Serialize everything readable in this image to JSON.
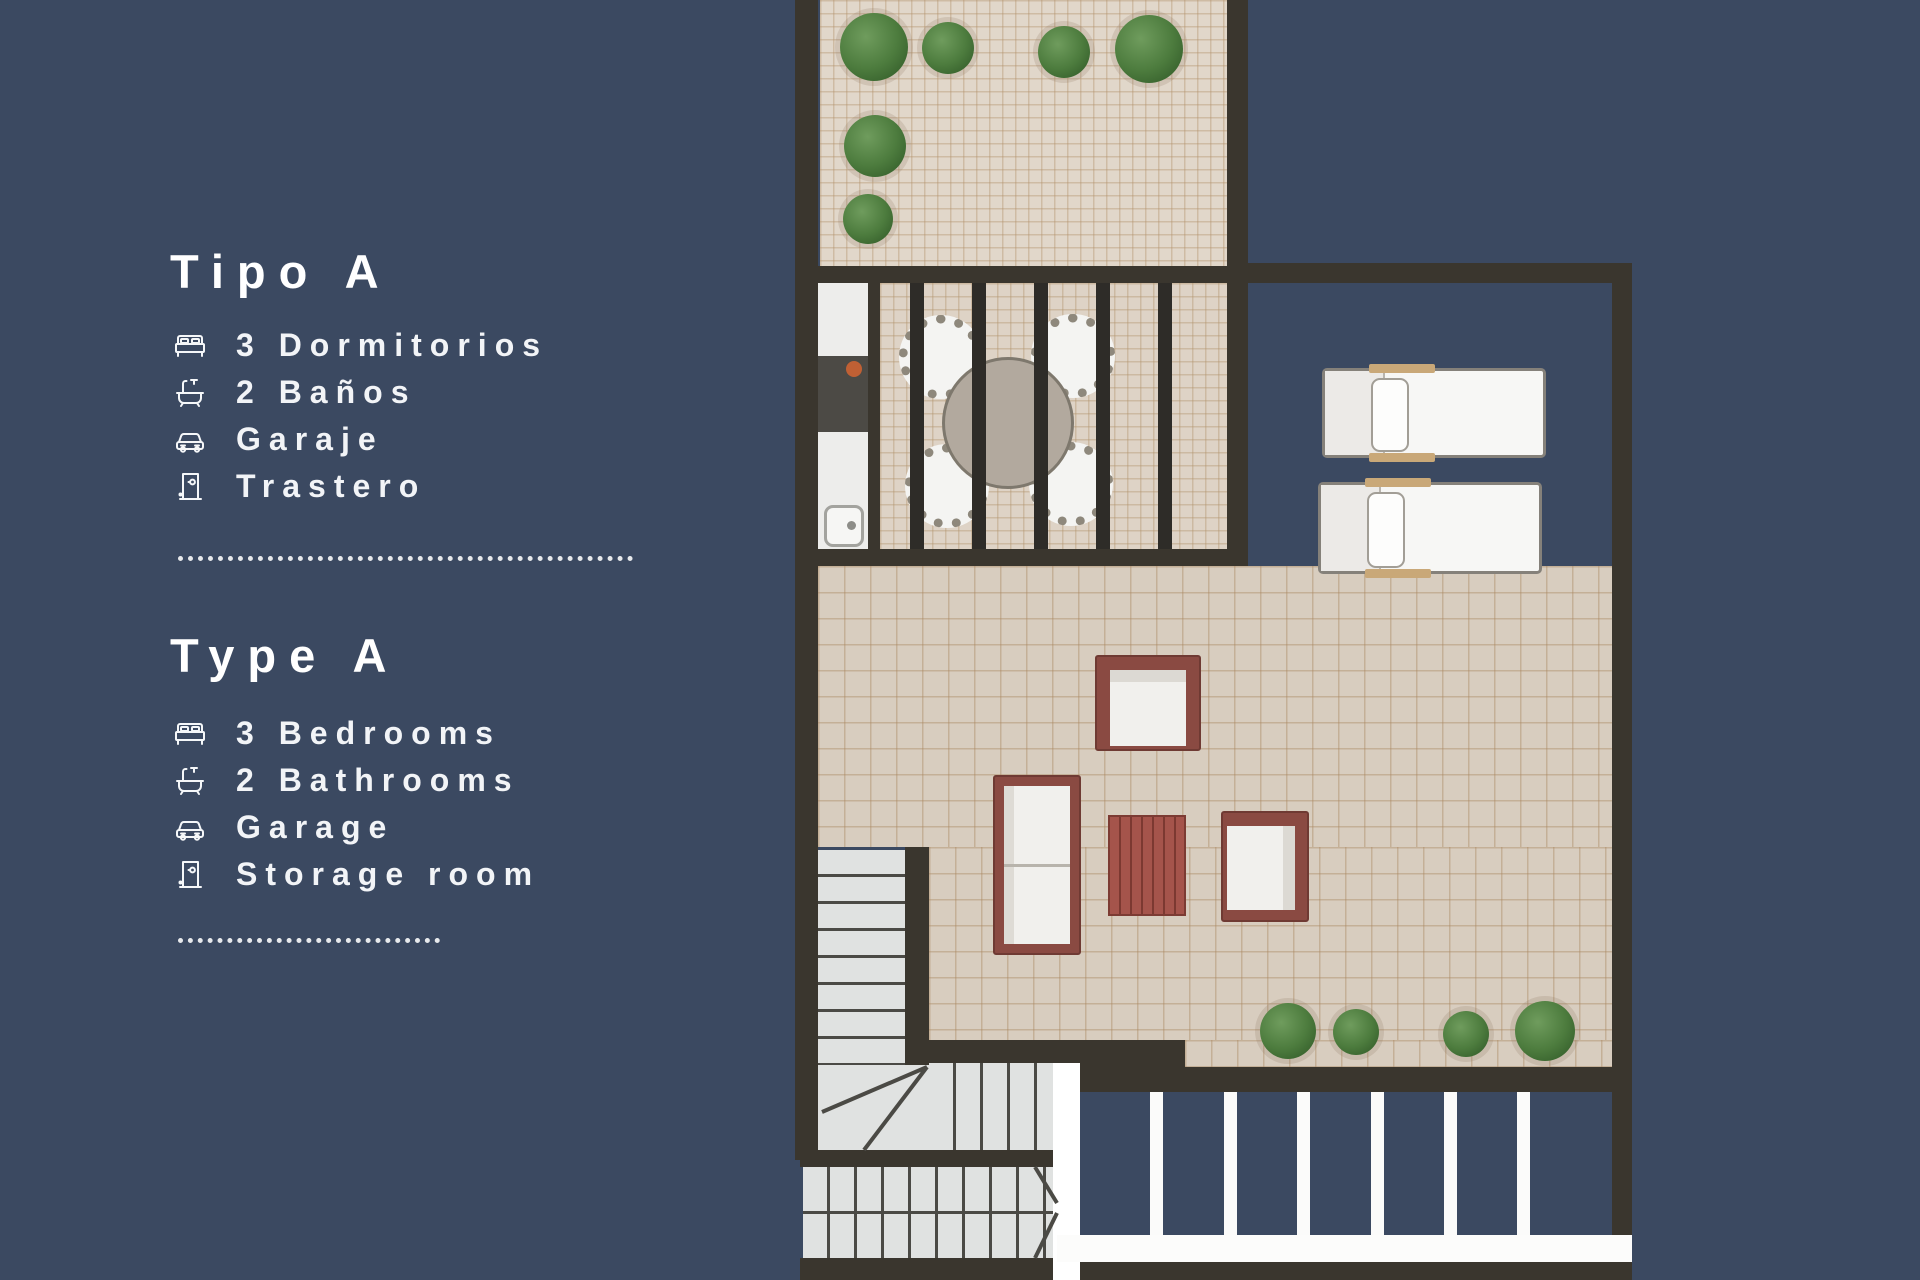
{
  "colors": {
    "background": "#3b4961",
    "wall": "#3a362e",
    "tile": "#d8cdbf",
    "furniture_wood": "#8a4a42",
    "plant_green": "#4d7c3e",
    "text": "#ffffff"
  },
  "legend_es": {
    "title": "Tipo A",
    "items": [
      {
        "icon": "bed-icon",
        "text": "3 Dormitorios"
      },
      {
        "icon": "bath-icon",
        "text": "2 Baños"
      },
      {
        "icon": "car-icon",
        "text": "Garaje"
      },
      {
        "icon": "door-icon",
        "text": "Trastero"
      }
    ]
  },
  "legend_en": {
    "title": "Type A",
    "items": [
      {
        "icon": "bed-icon",
        "text": "3 Bedrooms"
      },
      {
        "icon": "bath-icon",
        "text": "2 Bathrooms"
      },
      {
        "icon": "car-icon",
        "text": "Garage"
      },
      {
        "icon": "door-icon",
        "text": "Storage room"
      }
    ]
  }
}
